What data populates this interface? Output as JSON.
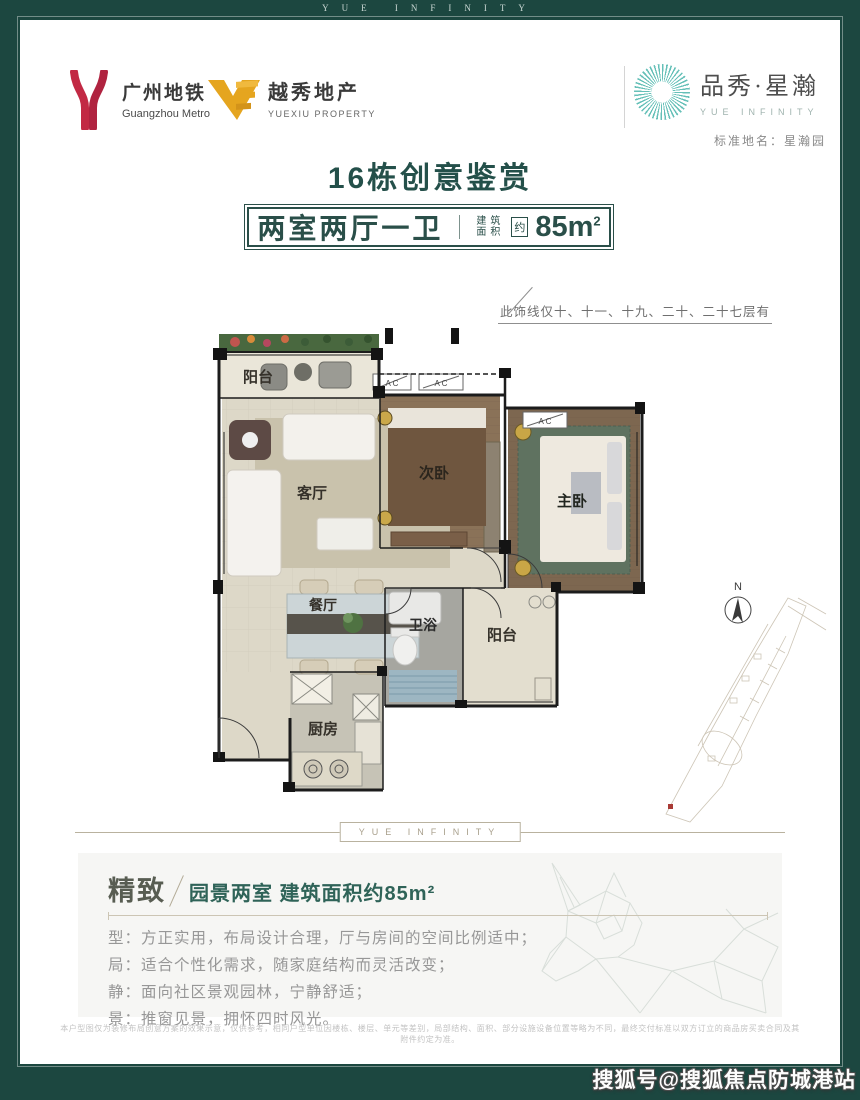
{
  "frame": {
    "band_text": "YUE INFINITY"
  },
  "header": {
    "metro": {
      "cn": "广州地铁",
      "en": "Guangzhou Metro"
    },
    "yuexiu": {
      "cn": "越秀地产",
      "en": "YUEXIU PROPERTY"
    },
    "brand": {
      "cn": "品秀·星瀚",
      "en": "YUE INFINITY",
      "standard_name": "标准地名：星瀚园"
    }
  },
  "title": "16栋创意鉴赏",
  "spec_box": {
    "layout": "两室两厅一卫",
    "area_label_line1": "建筑",
    "area_label_line2": "面积",
    "approx": "约",
    "area_value": "85m",
    "area_sup": "2"
  },
  "floorplan": {
    "note": "此饰线仅十、十一、十九、二十、二十七层有",
    "rooms": {
      "balcony_top": "阳台",
      "living": "客厅",
      "bedroom2": "次卧",
      "master": "主卧",
      "dining": "餐厅",
      "bath": "卫浴",
      "balcony_bottom": "阳台",
      "kitchen": "厨房"
    },
    "ac_label": "A C",
    "compass_n": "N"
  },
  "divider": {
    "band_text": "YUE INFINITY"
  },
  "feature": {
    "headline_bold": "精致",
    "headline_rest": "园景两室 建筑面积约85m²",
    "lines": [
      "型：方正实用，布局设计合理，厅与房间的空间比例适中；",
      "局：适合个性化需求，随家庭结构而灵活改变；",
      "静：面向社区景观园林，宁静舒适；",
      "景：推窗见景，拥怀四时风光。"
    ]
  },
  "disclaimer": "本户型图仅为装修布局创意方案的效果示意，仅供参考，相同户型单位因楼栋、楼层、单元等差别，局部结构、面积、部分设施设备位置等略为不同，最终交付标准以双方订立的商品房买卖合同及其附件约定为准。",
  "watermark": "搜狐号@搜狐焦点防城港站",
  "colors": {
    "frame_green": "#1c4740",
    "title_teal": "#24504a",
    "metro_red": "#c22944",
    "yuexiu_gold": "#e5a51f",
    "sunburst_teal": "#66c0b8",
    "feature_teal": "#2f6358",
    "tan_line": "#b9b29f"
  }
}
